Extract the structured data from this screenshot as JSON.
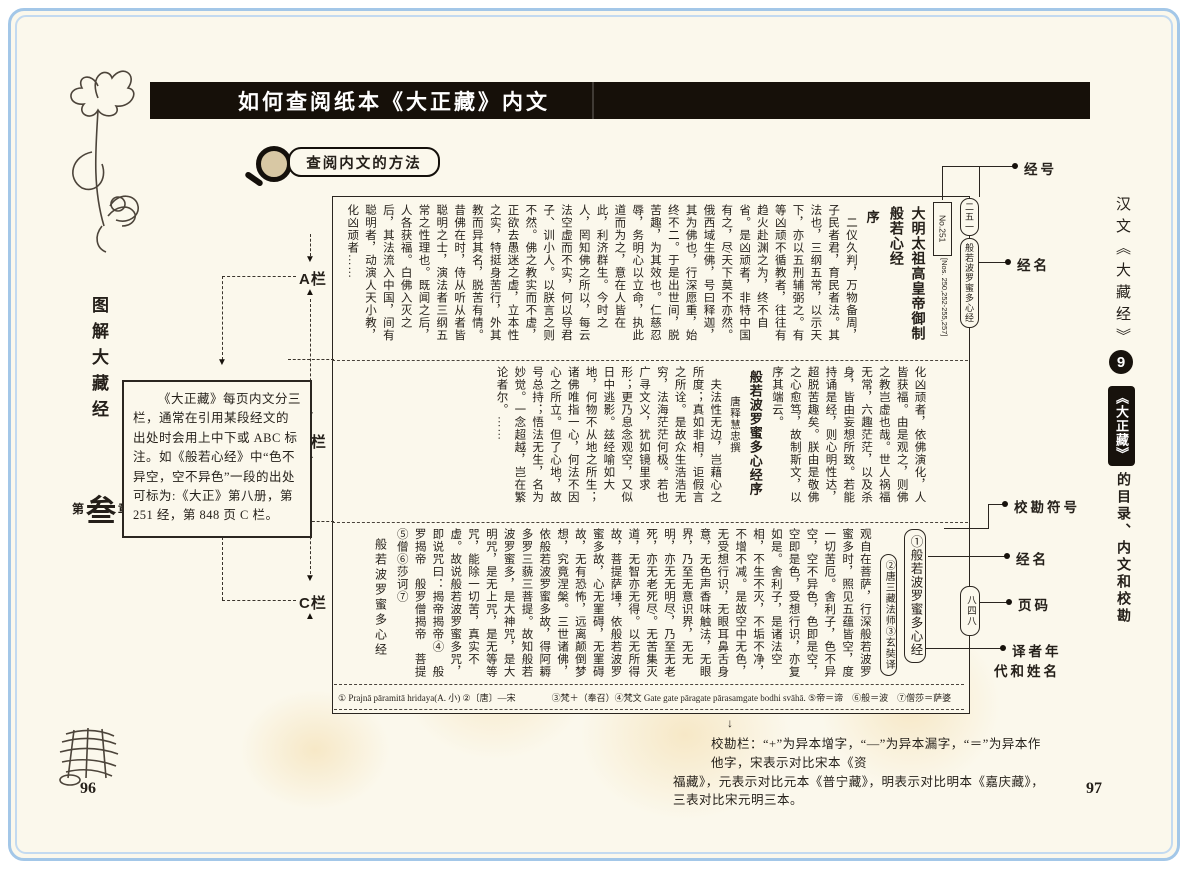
{
  "header": {
    "title": "如何查阅纸本《大正藏》内文"
  },
  "method": {
    "label": "查阅内文的方法"
  },
  "left_sidebar": {
    "series_title": "图解大藏经",
    "chapter_prefix": "第",
    "chapter_number": "叁",
    "chapter_suffix": "章"
  },
  "right_sidebar": {
    "strip_title": "汉文《大藏经》",
    "section_number": "9",
    "chapter_black": "《大正藏》",
    "chapter_rest": "的目录、内文和校勘"
  },
  "column_labels": {
    "a": "A栏",
    "b": "B栏",
    "c": "C栏"
  },
  "explain_box": {
    "text": "《大正藏》每页内文分三栏，通常在引用某段经文的出处时会用上中下或 ABC 标注。如《般若心经》中“色不异空，空不异色”一段的出处可标为:《大正》第八册，第 251 经，第 848 页 C 栏。"
  },
  "annotations": {
    "jing_hao": "经号",
    "jing_ming_top": "经名",
    "xiao_kan_fu_hao": "校勘符号",
    "jing_ming_bottom": "经名",
    "ye_ma": "页码",
    "yi_zhe_line1": "译者年",
    "yi_zhe_line2": "代和姓名",
    "running_no": "二五一",
    "running_title": "般若波罗蜜多心经",
    "page_no_oval": "八四八",
    "sutra_no": "No.251",
    "sutra_no_refs": "[Nos. 250,252-255,257]"
  },
  "taisho_page": {
    "band_a": {
      "cols": [
        {
          "t": "大明太祖高皇帝御制般若心经",
          "c": "title"
        },
        {
          "t": "序",
          "c": "subtitle"
        },
        {
          "t": "　二仪久判，万物备周，子民者君，育民者法。其法也，三纲五常，以示天下，亦以五刑辅弼之。有等凶顽不循教者，往往有趋火赴渊之为，终不自省。是凶顽者，非特中国有之，尽天下莫不亦然。俄西域生佛，号曰释迦，其为佛也，行深愿重，始终不二。于是出世间，脱苦趣，为其效也。仁慈忍辱，务明心以立命，执此道而为之，意在人皆在此，利济群生。今时之人，罔知佛之所以，每云法空虚而不实，何以导君子、训小人。以朕言之则不然。佛之教实而不虚，正欲去愚迷之虚，立本性之实，特挺身苦行，外其教而异其名，脱苦有情。昔佛在时，侍从听从者皆聪明之士，演法者三纲五常之性理也。既闻之后，人各获福。白佛入灭之后，其法流入中国，间有聪明者，动演人天小教，化凶顽者……",
          "c": "body"
        }
      ]
    },
    "band_b": {
      "cols": [
        {
          "t": "化凶顽者，依佛演化，人皆获福。由是观之，则佛之教岂虚也哉。世人祸福无常，六趣茫茫，以及杀身，皆由妄想所致。若能持诵是经，则心明性达，超脱苦趣矣。朕由是敬佛之心愈笃，故制斯文，以序其端云。",
          "c": "body"
        },
        {
          "t": "般若波罗蜜多心经序",
          "c": "title2"
        },
        {
          "t": "唐释慧忠撰",
          "c": "byline"
        },
        {
          "t": "　夫法性无边，岂藉心之所度；真如非相，讵假言之所诠。是故众生浩浩无穷，法海茫茫何极。若也广寻文义，犹如镜里求形；更乃息念观空，又似日中逃影。兹经喻如大地，何物不从地之所生；诸佛唯指一心，何法不因心之所立。但了心地，故号总持；悟法无生，名为妙觉。一念超越，岂在繁论者尔。……",
          "c": "body"
        }
      ]
    },
    "band_c": {
      "cols": [
        {
          "t": "①般若波罗蜜多心经",
          "c": "c1",
          "s": "oval"
        },
        {
          "t": "②唐三藏法师③玄奘译",
          "c": "c2",
          "s": "oval"
        },
        {
          "t": "观自在菩萨，行深般若波罗蜜多时，照见五蕴皆空，度一切苦厄。舍利子，色不异空，空不异色，色即是空，空即是色，受想行识，亦复如是。舍利子，是诸法空相，不生不灭，不垢不净，不增不减。是故空中无色，无受想行识，无眼耳鼻舌身意，无色声香味触法，无眼界，乃至无意识界，无无明，亦无无明尽，乃至无老死，亦无老死尽。无苦集灭道，无智亦无得。以无所得故，菩提萨埵，依般若波罗蜜多故，心无罣碍，无罣碍故，无有恐怖，远离颠倒梦想，究竟涅槃。三世诸佛，依般若波罗蜜多故，得阿耨多罗三藐三菩提。故知般若波罗蜜多，是大神咒，是大明咒，是无上咒，是无等等咒，能除一切苦，真实不虚。故说般若波罗蜜多咒，即说咒曰：揭帝揭帝④　般罗揭帝　般罗僧揭帝　菩提⑤僧⑥莎诃⑦",
          "c": "body"
        },
        {
          "t": "般若波罗蜜多心经",
          "c": "endtitle"
        }
      ]
    },
    "apparatus": {
      "left": "① Prajnā pāramitā hridaya(A. 小) ②〔唐〕—宋",
      "right": "③梵＋（奉召）④梵文 Gate gate pāragate pārasamgate bodhi svāhā. ⑤帝＝谛　⑥般＝波　⑦僧莎＝萨婆"
    }
  },
  "footnote": {
    "line1": "校勘栏：“+”为异本增字，“—”为异本漏字，“＝”为异本作他字，宋表示对比宋本《资",
    "line2": "福藏》，元表示对比元本《普宁藏》，明表示对比明本《嘉庆藏》，三表对比宋元明三本。"
  },
  "page": {
    "left_page_no": "96",
    "right_page_no": "97"
  }
}
